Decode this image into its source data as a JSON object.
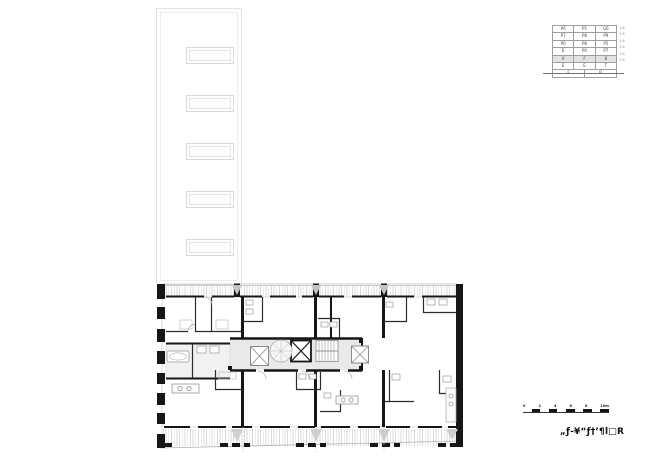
{
  "window": {
    "width": 650,
    "height": 459,
    "background": "#ffffff"
  },
  "floor_stack_table": {
    "rows": [
      {
        "cells": [
          "P6",
          "P5",
          "G6"
        ],
        "note": "1.6"
      },
      {
        "cells": [
          "P7",
          "P8",
          "P9"
        ],
        "note": "1.6"
      },
      {
        "cells": [
          "P0",
          "P8",
          "P5"
        ],
        "note": "1.6"
      },
      {
        "cells": [
          "E",
          "P0",
          "P7"
        ],
        "note": "1.6"
      },
      {
        "cells": [
          "0",
          "F",
          "8"
        ],
        "note": "1.6"
      },
      {
        "cells": [
          "E",
          "E",
          "T"
        ],
        "note": "1.6"
      }
    ],
    "highlighted_row_index": 4,
    "highlight_color": "#e2e2e2",
    "footer_cells": [
      "F",
      "B"
    ]
  },
  "scale_bar": {
    "labels": [
      "0",
      "2",
      "4",
      "6",
      "8",
      "10m"
    ]
  },
  "drawing_title": {
    "text": "„ƒ-¥“ƒ†’¶l□R"
  },
  "plan": {
    "wall_color": "#161616",
    "corridor_fill": "#e9e9e9",
    "hatch_color": "#d9d9d9",
    "roof_outline_color": "#e2e2e2",
    "features": {
      "skylight_count": 5,
      "elevator_count": 3,
      "stair_count": 2,
      "party_wall_count": 3,
      "kitchen_island_count": 3,
      "bathtub_count": 1
    }
  }
}
